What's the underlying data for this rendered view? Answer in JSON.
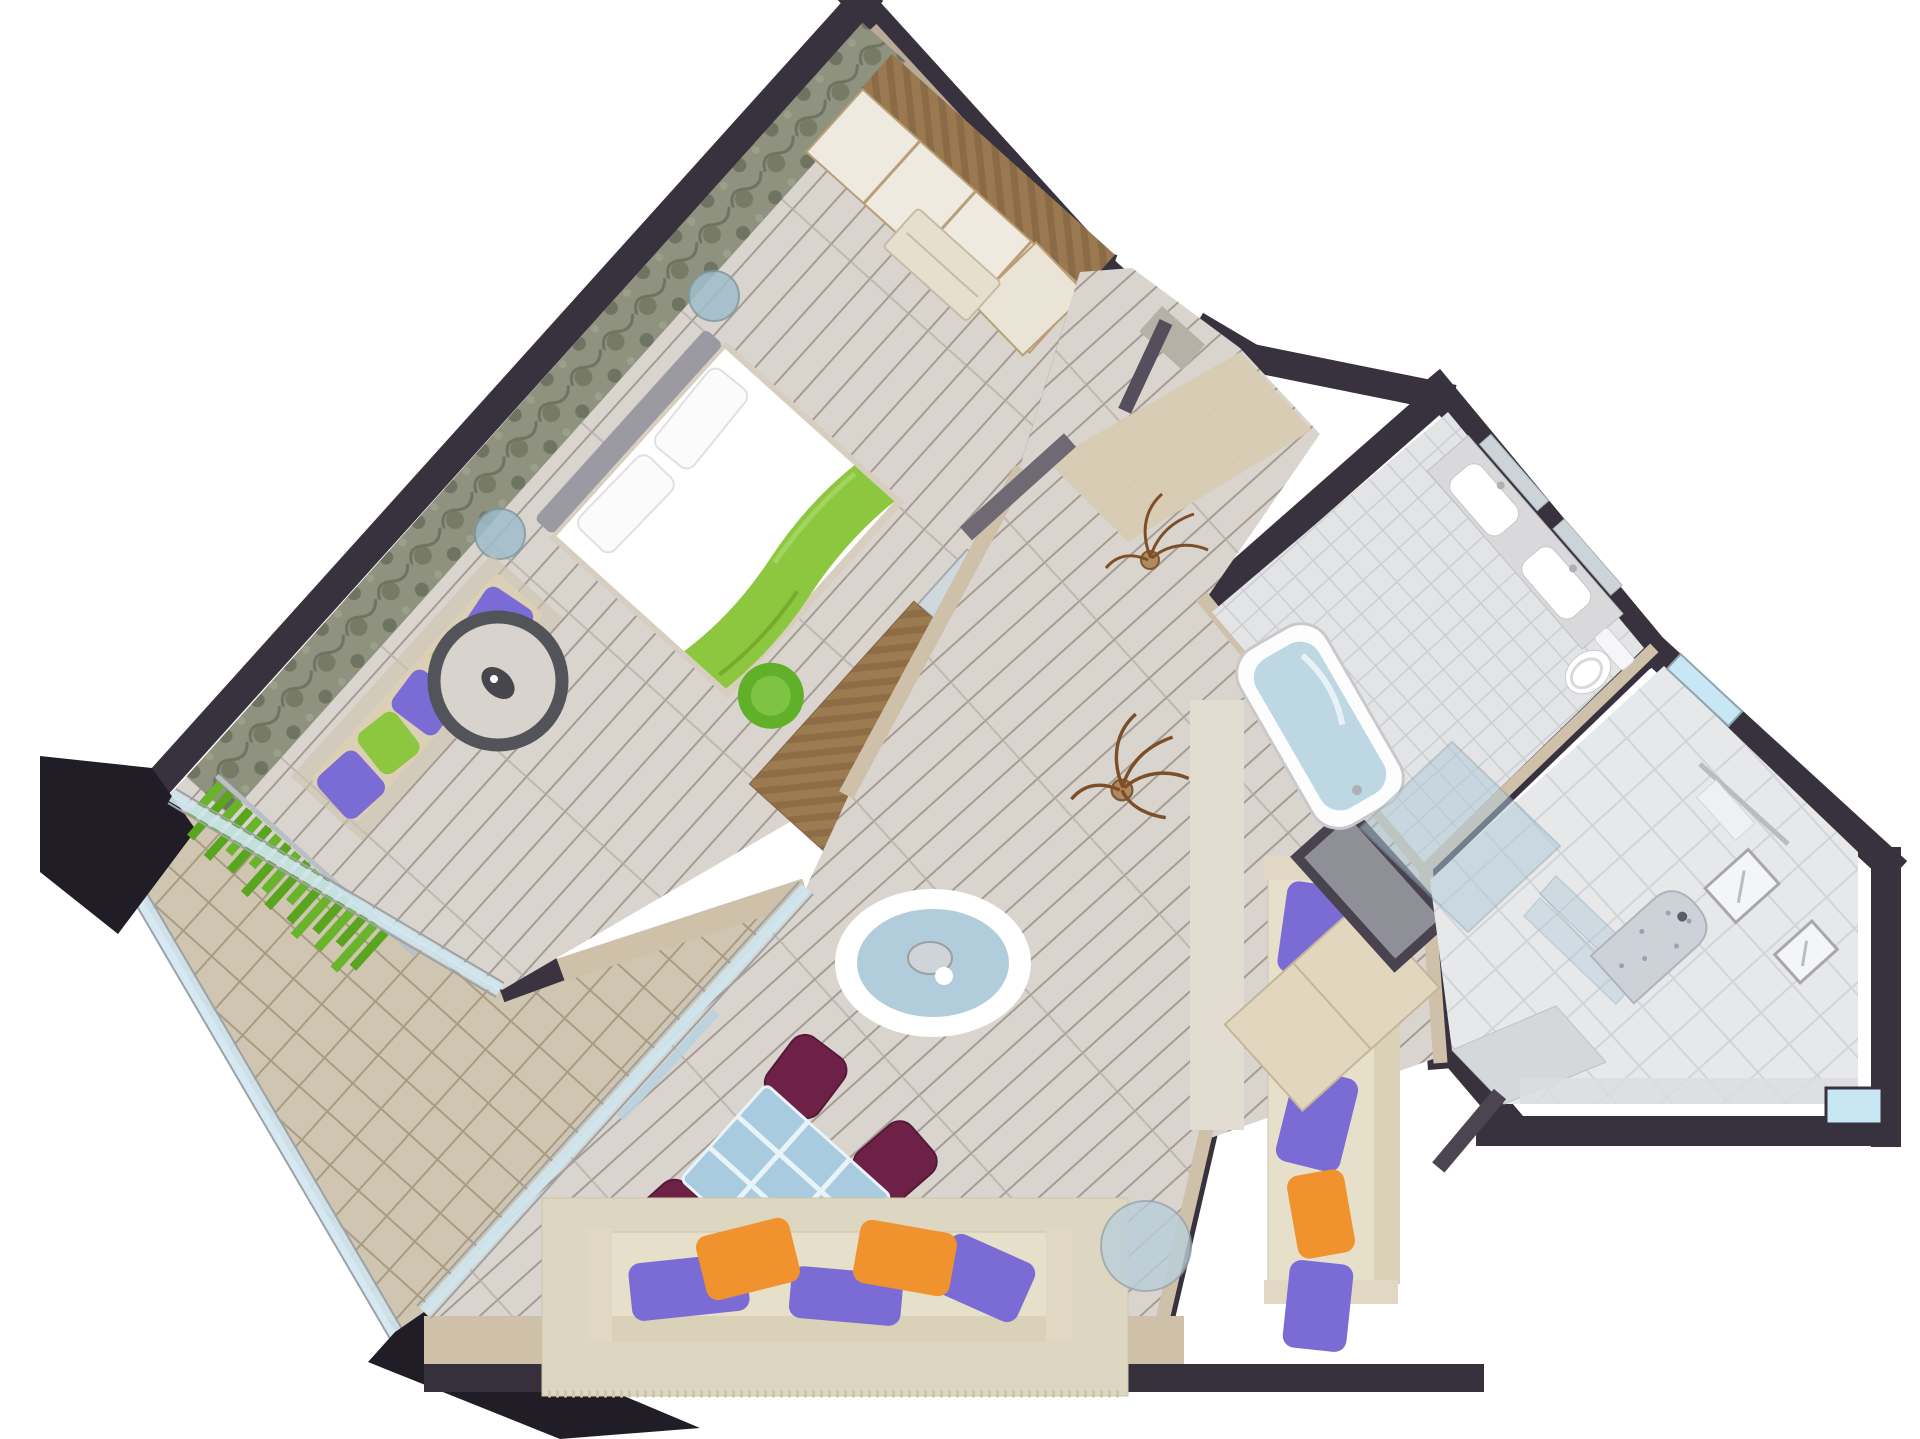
{
  "scene": {
    "type": "3d-floor-plan-render",
    "view": "top-down dollhouse",
    "rooms": [
      "bedroom",
      "balcony",
      "living-room",
      "entry-hall",
      "bathroom",
      "shower-room"
    ],
    "furniture": {
      "bedroom": [
        "wardrobe",
        "bench",
        "double-bed",
        "headboard",
        "nightstand",
        "daybed",
        "round-rug",
        "desk",
        "tv",
        "mirror",
        "desk-chair",
        "curtain"
      ],
      "living-room": [
        "sofa",
        "sofa-right",
        "coffee-table",
        "side-table",
        "dining-table",
        "dining-chairs",
        "cabinet",
        "closet-panel",
        "plants"
      ],
      "bathroom": [
        "double-vanity",
        "sinks",
        "mirrors",
        "toilet",
        "bathtub",
        "glass-enclosure"
      ],
      "shower-room": [
        "shower-niche",
        "bench",
        "towel-rail",
        "glass-shelves",
        "wall-frames",
        "window"
      ]
    }
  },
  "canvas": {
    "width": 1920,
    "height": 1439,
    "background": "#ffffff"
  },
  "palette": {
    "wall_dark": "#38323e",
    "wall_dark2": "#211d27",
    "wall_beige": "#cfc0aa",
    "wall_beige_light": "#dac9ae",
    "floor_plank": "#dad4cf",
    "plank_line": "#a59c94",
    "balcony_tile": "#cfc5b0",
    "balcony_line": "#a89c85",
    "bath_tile": "#e3e4e6",
    "bath_tile_big": "#e7e8ea",
    "bath_line": "#cbced2",
    "marble": "#d9d9db",
    "damask_base": "#8e927f",
    "damask_dot": "#6f7462",
    "glass": "#aecbd9",
    "glass_light": "#cfe6f0",
    "glass_frame": "#9aa3a8",
    "window_blue": "#c8e7f5",
    "green": "#8dc63f",
    "green_dark": "#61b02a",
    "purple": "#7b6bd4",
    "orange": "#f0922e",
    "plum": "#6d2147",
    "cream": "#e6dfc9",
    "cream_dark": "#d9d1b8",
    "rug_cream": "#ddd6c0",
    "wood": "#9a7950",
    "wood_dark": "#7e5e3c",
    "gray_headboard": "#9b9aa3",
    "tv_dark": "#3c3b43",
    "silver": "#c3c3c8",
    "water": "#bdd8e2",
    "white": "#ffffff"
  }
}
